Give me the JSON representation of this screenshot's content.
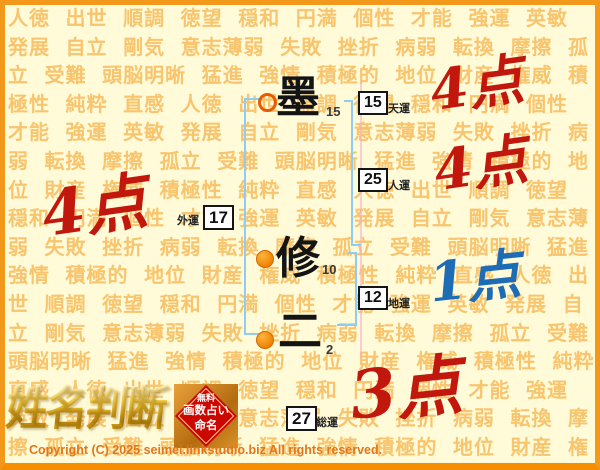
{
  "colors": {
    "frame_orange": "#F2991C",
    "frame_orange_dark": "#F78E00",
    "bg": "#FFFBD9",
    "bg_words": "#F8C56E",
    "score_red": "#C2170D",
    "score_blue": "#1D6CB5",
    "bracket_blue": "#8FCBF2",
    "stamp_red": "#CC0700",
    "copyright_orange": "#E2761B"
  },
  "background": {
    "words": [
      "人徳",
      "出世",
      "順調",
      "徳望",
      "穏和",
      "円満",
      "個性",
      "才能",
      "強運",
      "英敏",
      "発展",
      "自立",
      "剛気",
      "意志薄弱",
      "失敗",
      "挫折",
      "病弱",
      "転換",
      "摩擦",
      "孤立",
      "受難",
      "頭脳明晰",
      "猛進",
      "強情",
      "積極的",
      "地位",
      "財産",
      "権威",
      "積極性",
      "純粋",
      "直感"
    ]
  },
  "chart": {
    "characters": [
      {
        "char": "墨",
        "strokes": "15",
        "marker": "ring"
      },
      {
        "char": "修",
        "strokes": "10",
        "marker": "dot"
      },
      {
        "char": "二",
        "strokes": "2",
        "marker": "dot"
      }
    ],
    "fortunes": {
      "tenun": {
        "label": "天運",
        "value": "15"
      },
      "jinun": {
        "label": "人運",
        "value": "25"
      },
      "gaiun": {
        "label": "外運",
        "value": "17"
      },
      "chiun": {
        "label": "地運",
        "value": "12"
      },
      "souun": {
        "label": "総運",
        "value": "27"
      }
    },
    "scores": {
      "tenun": "4点",
      "jinun": "4点",
      "gaiun": "4点",
      "chiun": "1点",
      "souun": "3点"
    }
  },
  "branding": {
    "logo_text": "姓名判断",
    "stamp": {
      "line1": "無料",
      "line2": "画数占い",
      "line3": "命名"
    }
  },
  "footer": {
    "copyright": "Copyright (C) 2025 seimei.linkstudio.biz All rights reserved."
  }
}
